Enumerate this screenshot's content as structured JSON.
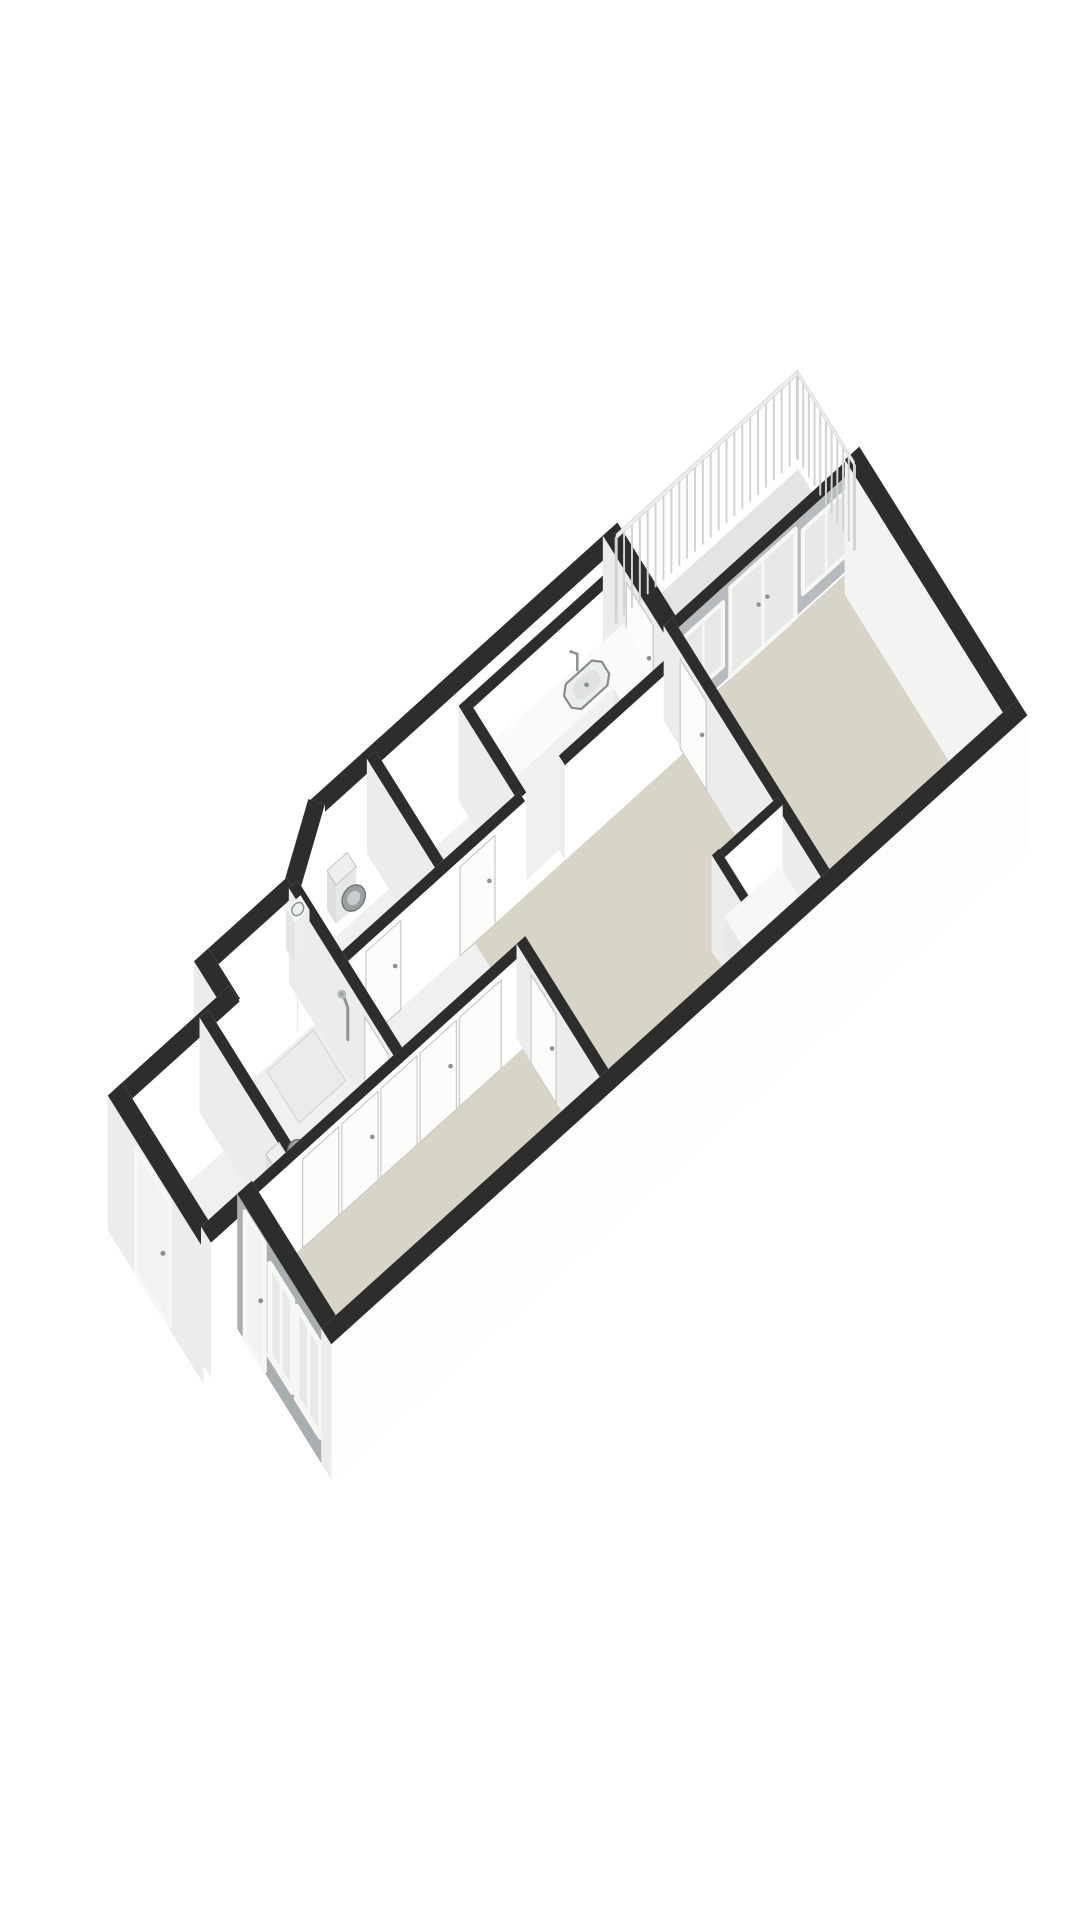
{
  "scene": {
    "canvas": {
      "w": 1080,
      "h": 1920,
      "background": "#ffffff"
    },
    "projection": {
      "origin": [
        75,
        1025
      ],
      "ax": [
        0.725,
        -0.655
      ],
      "ay": [
        0.5,
        0.8
      ],
      "floor_z": 95,
      "ext_z": 135,
      "rail_top_z": 8,
      "rail_bottom_z": 96
    },
    "palette": {
      "cap": "#2d2d2d",
      "face_s": "#ffffff",
      "face_n": "#efefef",
      "face_e": "#f8f8f8",
      "face_w": "#ececec",
      "beige": "#d8d4c8",
      "floor_light": "#f0f0ee",
      "floor_mid": "#ebebe9",
      "balcony": "#e4e4e2",
      "glass": "#e7e9e6",
      "frame": "#f7f7f5",
      "frame_line": "#c9c9c7",
      "facade": "#a9aeb1",
      "accent": "#b7bbbd",
      "rail_band": "#edefee",
      "rail_post": "#d2d4d3",
      "rail_edge": "#d3d5d4",
      "fixture_stroke": "#878d8e",
      "fixture_fill": "#eceeec",
      "fixture_dark": "#9aa0a1",
      "fixture_dark_edge": "#707677",
      "fixture_ring": "#c9cdcd",
      "tank_fill": "#eef0ef",
      "tank_edge": "#c2c4c3",
      "metal": "#8f9597",
      "handle": "#8f8f8f",
      "mat": "#dcd8cc",
      "tray_edge": "#d9d9d7"
    },
    "floors": [
      {
        "name": "balcony-floor",
        "color": "balcony",
        "pts": [
          [
            757,
            2
          ],
          [
            996,
            2
          ],
          [
            996,
            106
          ],
          [
            757,
            106
          ]
        ]
      },
      {
        "name": "shaft-floor",
        "color": "floor_mid",
        "pts": [
          [
            526,
            4
          ],
          [
            740,
            4
          ],
          [
            740,
            22
          ],
          [
            526,
            22
          ]
        ]
      },
      {
        "name": "kitchen-floor",
        "color": "floor_light",
        "pts": [
          [
            526,
            34
          ],
          [
            734,
            34
          ],
          [
            734,
            134
          ],
          [
            526,
            134
          ]
        ]
      },
      {
        "name": "storage-floor",
        "color": "floor_light",
        "pts": [
          [
            416,
            34
          ],
          [
            514,
            34
          ],
          [
            514,
            134
          ],
          [
            416,
            134
          ]
        ]
      },
      {
        "name": "wc-floor",
        "color": "floor_light",
        "pts": [
          [
            276,
            55
          ],
          [
            330,
            12
          ],
          [
            404,
            12
          ],
          [
            404,
            134
          ],
          [
            276,
            134
          ]
        ]
      },
      {
        "name": "hall-floor",
        "color": "floor_light",
        "pts": [
          [
            276,
            146
          ],
          [
            450,
            146
          ],
          [
            450,
            254
          ],
          [
            276,
            254
          ]
        ]
      },
      {
        "name": "bath-floor",
        "color": "floor_light",
        "pts": [
          [
            126,
            96
          ],
          [
            264,
            96
          ],
          [
            264,
            254
          ],
          [
            126,
            254
          ]
        ]
      },
      {
        "name": "shower-tray",
        "color": "floor_mid",
        "stroke": "tray_edge",
        "pts": [
          [
            196,
            100
          ],
          [
            260,
            100
          ],
          [
            260,
            164
          ],
          [
            196,
            164
          ]
        ]
      },
      {
        "name": "leftroom-floor",
        "color": "floor_light",
        "pts": [
          [
            12,
            96
          ],
          [
            114,
            96
          ],
          [
            114,
            254
          ],
          [
            12,
            254
          ]
        ]
      },
      {
        "name": "door-mat",
        "color": "mat",
        "pts": [
          [
            12,
            150
          ],
          [
            34,
            150
          ],
          [
            34,
            210
          ],
          [
            12,
            210
          ]
        ]
      },
      {
        "name": "bedroom2-floor",
        "color": "beige",
        "pts": [
          [
            72,
            266
          ],
          [
            434,
            266
          ],
          [
            434,
            420
          ],
          [
            72,
            420
          ]
        ]
      },
      {
        "name": "living-floor",
        "color": "beige",
        "pts": [
          [
            450,
            146
          ],
          [
            739,
            146
          ],
          [
            739,
            324
          ],
          [
            666,
            324
          ],
          [
            666,
            420
          ],
          [
            450,
            420
          ]
        ]
      },
      {
        "name": "closet-floor",
        "color": "floor_light",
        "pts": [
          [
            668,
            338
          ],
          [
            739,
            338
          ],
          [
            739,
            420
          ],
          [
            668,
            420
          ]
        ]
      },
      {
        "name": "bedroom1-floor",
        "color": "beige",
        "pts": [
          [
            751,
            120
          ],
          [
            994,
            120
          ],
          [
            994,
            420
          ],
          [
            751,
            420
          ]
        ]
      }
    ],
    "walls": [
      {
        "name": "ext-wall-north-kitchen",
        "from": [
          330,
          0
        ],
        "to": [
          745,
          0
        ],
        "t": 20,
        "kind": "ext",
        "depth": 0
      },
      {
        "name": "wall-chamfer-wc",
        "from": [
          262,
          50
        ],
        "to": [
          336,
          -4
        ],
        "t": 20,
        "kind": "ext",
        "depth": 23
      },
      {
        "name": "int-wall-shaft",
        "from": [
          514,
          28
        ],
        "to": [
          745,
          28
        ],
        "t": 12,
        "kind": "int",
        "depth": 28
      },
      {
        "name": "ext-wall-north-mid",
        "from": [
          150,
          45
        ],
        "to": [
          268,
          45
        ],
        "t": 20,
        "kind": "ext",
        "depth": 45
      },
      {
        "name": "ext-wall-kitchen-balcony",
        "from": [
          745,
          -10
        ],
        "to": [
          745,
          112
        ],
        "t": 20,
        "kind": "ext",
        "depth": 51,
        "decals": [
          {
            "face": "nx",
            "type": "door",
            "a": 38,
            "b": 92,
            "zt": 8,
            "zb": 95,
            "handle": true
          }
        ]
      },
      {
        "name": "ext-wall-step-north",
        "from": [
          150,
          35
        ],
        "to": [
          150,
          98
        ],
        "t": 20,
        "kind": "ext",
        "depth": 66
      },
      {
        "name": "int-wall-wc-storage",
        "from": [
          410,
          -2
        ],
        "to": [
          410,
          140
        ],
        "t": 12,
        "kind": "int",
        "depth": 69
      },
      {
        "name": "int-wall-storage-kitchen",
        "from": [
          520,
          28
        ],
        "to": [
          520,
          140
        ],
        "t": 12,
        "kind": "int",
        "depth": 84
      },
      {
        "name": "ext-wall-north-left",
        "from": [
          0,
          90
        ],
        "to": [
          158,
          90
        ],
        "t": 20,
        "kind": "ext",
        "depth": 90
      },
      {
        "name": "accent-wall-balcony",
        "from": [
          739,
          112
        ],
        "to": [
          1000,
          112
        ],
        "t": 12,
        "kind": "int",
        "depth": 112,
        "colors": {
          "s": "accent"
        },
        "decals": [
          {
            "face": "py",
            "type": "window",
            "a": 758,
            "b": 812,
            "zt": 14,
            "zb": 78
          },
          {
            "face": "py",
            "type": "glassdoor",
            "a": 822,
            "b": 912,
            "zt": 6,
            "zb": 95
          },
          {
            "face": "py",
            "type": "window",
            "a": 922,
            "b": 986,
            "zt": 14,
            "zb": 78
          }
        ]
      },
      {
        "name": "int-wall-hall-north-a",
        "from": [
          264,
          140
        ],
        "to": [
          520,
          140
        ],
        "t": 12,
        "kind": "int",
        "depth": 140,
        "decals": [
          {
            "face": "py",
            "type": "door",
            "a": 300,
            "b": 348,
            "zt": 6,
            "zb": 95,
            "handle": true
          },
          {
            "face": "py",
            "type": "door",
            "a": 430,
            "b": 478,
            "zt": 6,
            "zb": 95,
            "handle": true
          }
        ]
      },
      {
        "name": "int-wall-kitchen-living",
        "from": [
          575,
          140
        ],
        "to": [
          751,
          140
        ],
        "t": 12,
        "kind": "int",
        "depth": 140
      },
      {
        "name": "int-wall-bath-hall",
        "from": [
          270,
          45
        ],
        "to": [
          270,
          266
        ],
        "t": 12,
        "kind": "int",
        "depth": 155,
        "decals": [
          {
            "face": "nx",
            "type": "shower",
            "a": 148,
            "b": 175,
            "zt": 14,
            "zb": 60
          },
          {
            "face": "nx",
            "type": "door",
            "a": 198,
            "b": 246,
            "zt": 6,
            "zb": 95,
            "handle": true
          }
        ]
      },
      {
        "name": "int-wall-left-bath",
        "from": [
          120,
          84
        ],
        "to": [
          120,
          266
        ],
        "t": 12,
        "kind": "int",
        "depth": 175
      },
      {
        "name": "ext-wall-west",
        "from": [
          0,
          80
        ],
        "to": [
          0,
          272
        ],
        "t": 20,
        "kind": "ext",
        "depth": 176,
        "decals": [
          {
            "face": "nx",
            "type": "door_ext",
            "a": 138,
            "b": 205,
            "zt": 6,
            "zb": 130,
            "handle": true
          }
        ]
      },
      {
        "name": "int-wall-closets",
        "from": [
          55,
          260
        ],
        "to": [
          446,
          260
        ],
        "t": 12,
        "kind": "int",
        "depth": 260,
        "decals": [
          {
            "face": "py",
            "type": "panel",
            "a": 130,
            "b": 180,
            "zt": 6,
            "zb": 95
          },
          {
            "face": "py",
            "type": "panel",
            "a": 184,
            "b": 234,
            "zt": 6,
            "zb": 95,
            "handle": true
          },
          {
            "face": "py",
            "type": "panel",
            "a": 238,
            "b": 288,
            "zt": 6,
            "zb": 95
          },
          {
            "face": "py",
            "type": "panel",
            "a": 292,
            "b": 342,
            "zt": 6,
            "zb": 95,
            "handle": true
          },
          {
            "face": "py",
            "type": "panel",
            "a": 346,
            "b": 404,
            "zt": 6,
            "zb": 95
          }
        ]
      },
      {
        "name": "ext-wall-step-west",
        "from": [
          0,
          262
        ],
        "to": [
          66,
          262
        ],
        "t": 20,
        "kind": "ext",
        "depth": 262
      },
      {
        "name": "int-wall-living-bedroom1",
        "from": [
          745,
          106
        ],
        "to": [
          745,
          436
        ],
        "t": 12,
        "kind": "int",
        "depth": 271,
        "decals": [
          {
            "face": "nx",
            "type": "door",
            "a": 140,
            "b": 192,
            "zt": 6,
            "zb": 95,
            "handle": true
          }
        ]
      },
      {
        "name": "ext-wall-east",
        "from": [
          1000,
          104
        ],
        "to": [
          1000,
          440
        ],
        "t": 20,
        "kind": "ext",
        "depth": 300,
        "colors": {
          "w": "#f3f3f3"
        }
      },
      {
        "name": "closet-wall-north",
        "from": [
          654,
          330
        ],
        "to": [
          745,
          330
        ],
        "t": 10,
        "kind": "int",
        "depth": 330
      },
      {
        "name": "int-wall-bed2-living",
        "from": [
          440,
          254
        ],
        "to": [
          440,
          426
        ],
        "t": 12,
        "kind": "int",
        "depth": 345,
        "decals": [
          {
            "face": "nx",
            "type": "door",
            "a": 284,
            "b": 334,
            "zt": 6,
            "zb": 95,
            "handle": true
          }
        ]
      },
      {
        "name": "closet-wall-west",
        "from": [
          660,
          324
        ],
        "to": [
          660,
          428
        ],
        "t": 10,
        "kind": "int",
        "depth": 380
      },
      {
        "name": "ext-wall-facade",
        "from": [
          60,
          252
        ],
        "to": [
          60,
          430
        ],
        "t": 20,
        "kind": "ext",
        "depth": 420,
        "colors": {
          "w": "facade"
        },
        "decals": [
          {
            "face": "nx",
            "type": "door_ext",
            "a": 268,
            "b": 308,
            "zt": 4,
            "zb": 132,
            "handle": true
          },
          {
            "face": "nx",
            "type": "window_ext",
            "a": 318,
            "b": 364,
            "zt": 16,
            "zb": 108
          },
          {
            "face": "nx",
            "type": "window_ext",
            "a": 372,
            "b": 420,
            "zt": 16,
            "zb": 108
          }
        ]
      },
      {
        "name": "ext-wall-south",
        "from": [
          50,
          430
        ],
        "to": [
          1010,
          430
        ],
        "t": 20,
        "kind": "ext",
        "depth": 430,
        "colors": {
          "s": "#fdfdfd"
        }
      }
    ],
    "fixtures": [
      {
        "name": "wc-hand-basin",
        "type": "basin",
        "x1": 280,
        "y1": 16,
        "x2": 300,
        "y2": 34,
        "zt": 54,
        "depth": 158
      },
      {
        "name": "toilet-wc",
        "type": "toilet",
        "tank": [
          338,
          14,
          366,
          32
        ],
        "cx": 352,
        "cy": 47,
        "rx": 14,
        "ry": 12,
        "depth": 49
      },
      {
        "name": "kitchen-counter",
        "type": "box",
        "x1": 527,
        "y1": 35,
        "x2": 732,
        "y2": 80,
        "zt": 50,
        "top": "#fafaf8",
        "front": "#f0f0ee",
        "side": "#e8e8e6",
        "depth": 80
      },
      {
        "name": "kitchen-sink",
        "type": "sink",
        "x1": 640,
        "y1": 42,
        "x2": 692,
        "y2": 73,
        "z": 50,
        "depth": 80.5
      },
      {
        "name": "kitchen-faucet",
        "type": "faucet",
        "x": 666,
        "y": 39,
        "z": 50,
        "depth": 80.6
      },
      {
        "name": "kitchen-counter-wing",
        "type": "box",
        "x1": 688,
        "y1": 80,
        "x2": 732,
        "y2": 134,
        "zt": 50,
        "top": "#fafaf8",
        "front": "#f0f0ee",
        "side": "#e8e8e6",
        "depth": 133
      },
      {
        "name": "toilet-bathroom",
        "type": "toilet",
        "tank": [
          128,
          196,
          146,
          226
        ],
        "cx": 163,
        "cy": 211,
        "rx": 12,
        "ry": 14,
        "depth": 216
      },
      {
        "name": "radiator",
        "type": "box",
        "x1": 72,
        "y1": 292,
        "x2": 90,
        "y2": 344,
        "zt": 55,
        "top": "#f6f6f4",
        "front": "#eeeeec",
        "side": "#e6e6e4",
        "stroke": "#dcdcda",
        "depth": 344
      },
      {
        "name": "closet-shelf",
        "type": "box",
        "x1": 664,
        "y1": 336,
        "x2": 741,
        "y2": 426,
        "zt": 58,
        "top": "#f7f7f5",
        "front": "#eeeeec",
        "side": "#e8e8e6",
        "depth": 400
      },
      {
        "name": "balcony-railing",
        "type": "railing",
        "pts": [
          [
            752,
            -8
          ],
          [
            1002,
            -8
          ],
          [
            1002,
            106
          ]
        ],
        "step": 11,
        "depth": 500
      }
    ]
  }
}
